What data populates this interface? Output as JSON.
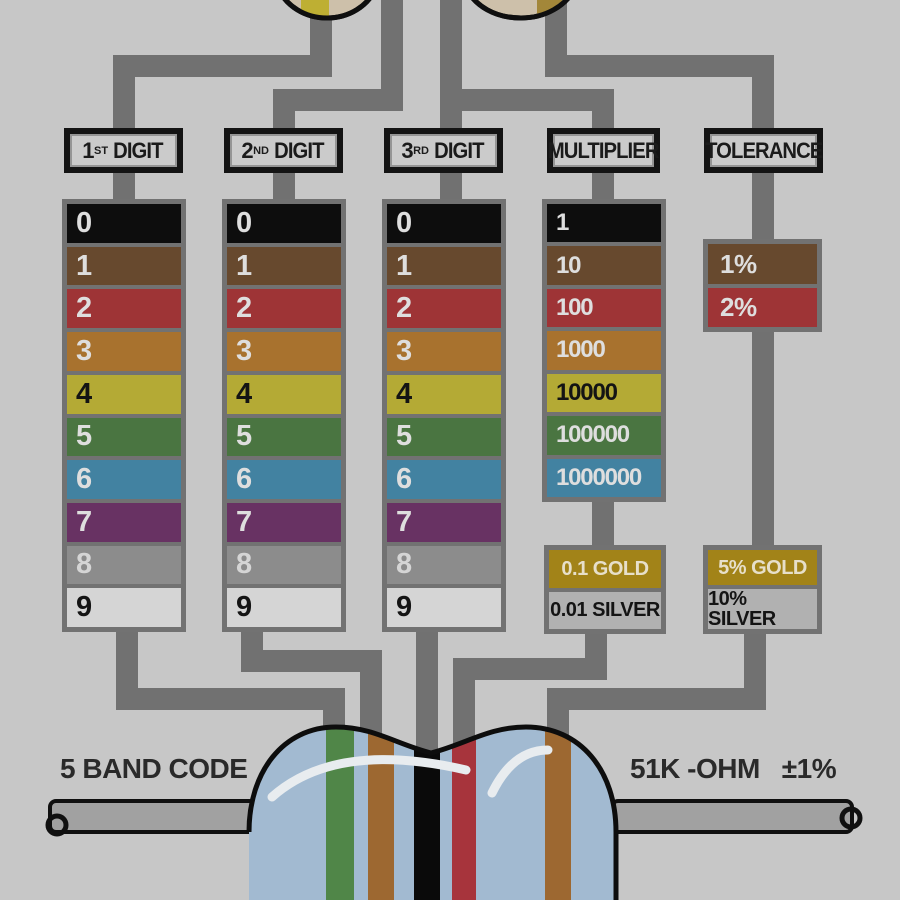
{
  "title": "Resistor color code chart",
  "headers": [
    {
      "num": "1",
      "sup": "ST",
      "word": "DIGIT"
    },
    {
      "num": "2",
      "sup": "ND",
      "word": "DIGIT"
    },
    {
      "num": "3",
      "sup": "RD",
      "word": "DIGIT"
    },
    {
      "num": "",
      "sup": "",
      "word": "MULTIPLIER"
    },
    {
      "num": "",
      "sup": "",
      "word": "TOLERANCE"
    }
  ],
  "digit_rows": [
    {
      "name": "black",
      "label": "0",
      "bg": "#0d0d0d",
      "fg": "#e3e3e3"
    },
    {
      "name": "brown",
      "label": "1",
      "bg": "#6b4a2c",
      "fg": "#e3e3e3"
    },
    {
      "name": "red",
      "label": "2",
      "bg": "#a93335",
      "fg": "#e3e3e3"
    },
    {
      "name": "orange",
      "label": "3",
      "bg": "#b07428",
      "fg": "#e3e3e3"
    },
    {
      "name": "yellow",
      "label": "4",
      "bg": "#b9ae2c",
      "fg": "#141414"
    },
    {
      "name": "green",
      "label": "5",
      "bg": "#49793f",
      "fg": "#e3e3e3"
    },
    {
      "name": "blue",
      "label": "6",
      "bg": "#3f86a8",
      "fg": "#e3e3e3"
    },
    {
      "name": "violet",
      "label": "7",
      "bg": "#6e3268",
      "fg": "#e3e3e3"
    },
    {
      "name": "gray",
      "label": "8",
      "bg": "#8f8f8f",
      "fg": "#d9d9d9"
    },
    {
      "name": "white",
      "label": "9",
      "bg": "#d9d9d9",
      "fg": "#141414"
    }
  ],
  "multiplier_rows": [
    {
      "name": "black",
      "label": "1",
      "bg": "#0d0d0d",
      "fg": "#e3e3e3"
    },
    {
      "name": "brown",
      "label": "10",
      "bg": "#6b4a2c",
      "fg": "#e3e3e3"
    },
    {
      "name": "red",
      "label": "100",
      "bg": "#a93335",
      "fg": "#e3e3e3"
    },
    {
      "name": "orange",
      "label": "1000",
      "bg": "#b07428",
      "fg": "#e3e3e3"
    },
    {
      "name": "yellow",
      "label": "10000",
      "bg": "#b9ae2c",
      "fg": "#141414"
    },
    {
      "name": "green",
      "label": "100000",
      "bg": "#49793f",
      "fg": "#e3e3e3"
    },
    {
      "name": "blue",
      "label": "1000000",
      "bg": "#3f86a8",
      "fg": "#e3e3e3"
    }
  ],
  "multiplier_extra": [
    {
      "name": "gold",
      "label": "0.1 GOLD",
      "bg": "#a8860f",
      "fg": "#ece4cc"
    },
    {
      "name": "silver",
      "label": "0.01 SILVER",
      "bg": "#b5b5b5",
      "fg": "#141414"
    }
  ],
  "tolerance_rows": [
    {
      "name": "brown",
      "label": "1%",
      "bg": "#6b4a2c",
      "fg": "#e3e3e3"
    },
    {
      "name": "red",
      "label": "2%",
      "bg": "#a93335",
      "fg": "#e3e3e3"
    }
  ],
  "tolerance_extra": [
    {
      "name": "gold",
      "label": "5% GOLD",
      "bg": "#a8860f",
      "fg": "#ece4cc"
    },
    {
      "name": "silver",
      "label": "10% SILVER",
      "bg": "#b5b5b5",
      "fg": "#141414"
    }
  ],
  "example": {
    "caption": "5 BAND CODE",
    "value": "51K -OHM",
    "tolerance": "±1%",
    "bands": [
      "green",
      "brown",
      "black",
      "red",
      "brown"
    ]
  },
  "palette": {
    "background": "#cbcbcb",
    "connector_gray": "#737373",
    "table_frame_gray": "#747474",
    "resistor_body_blue": "#a3bed8",
    "resistor_body_cream": "#d2c4ab",
    "lead_gray": "#a4a4a4"
  }
}
